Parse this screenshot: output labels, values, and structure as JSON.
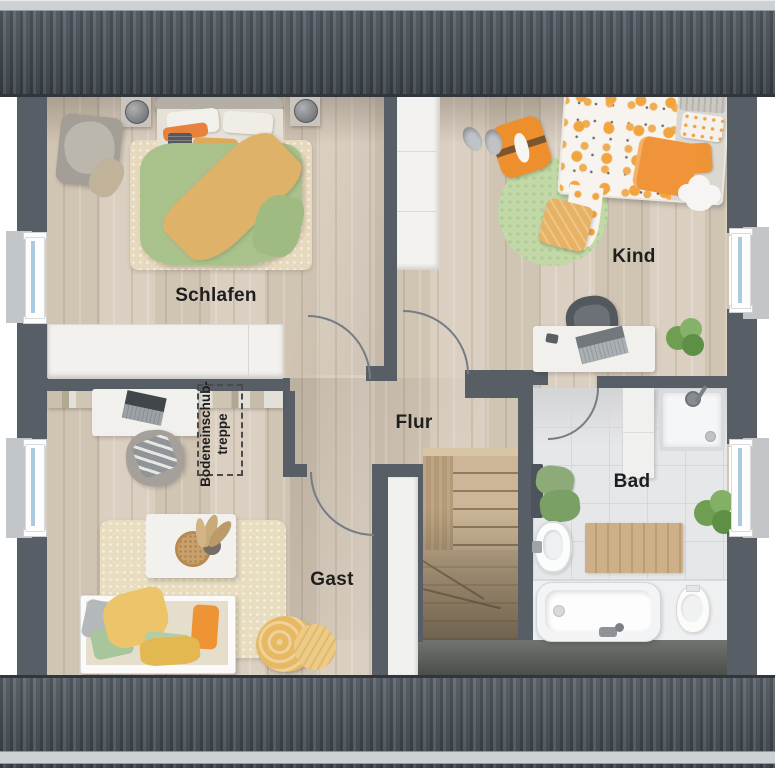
{
  "floorplan": {
    "type": "attic-floor-plan",
    "room_labels": [
      {
        "id": "schlafen",
        "label": "Schlafen"
      },
      {
        "id": "kind",
        "label": "Kind"
      },
      {
        "id": "flur",
        "label": "Flur"
      },
      {
        "id": "bad",
        "label": "Bad"
      },
      {
        "id": "gast",
        "label": "Gast"
      }
    ],
    "annotations": [
      {
        "id": "attic-hatch",
        "line1": "Bodeneinschub-",
        "line2": "treppe"
      }
    ],
    "colors": {
      "background": "#ffffff",
      "roof_dark": "#4a515a",
      "roof_stripe": "#394047",
      "roof_cap": "#ced1d4",
      "wall": "#575e66",
      "wood_floor": "#d7cbbb",
      "bathroom_tile": "#e6e7e9",
      "window_glass": "#a9cadf",
      "stair_wood": "#c6b192",
      "accent_orange": "#ee9434",
      "accent_green": "#a8c48e",
      "accent_yellow": "#e5b95f"
    },
    "furniture": {
      "schlafen": [
        "double-bed",
        "nightstand-lamps",
        "rug",
        "wardrobe",
        "bookshelf",
        "armchair-clothes"
      ],
      "kind": [
        "single-bed",
        "round-rug",
        "wardrobe",
        "desk",
        "desk-chair",
        "slippers",
        "floor-pillow",
        "cloud-rug",
        "plant"
      ],
      "gast": [
        "daybed",
        "coffee-table",
        "rug",
        "desk",
        "armchair",
        "blanket"
      ],
      "bad": [
        "shower",
        "bathtub",
        "toilet",
        "sink",
        "bath-mat",
        "towels",
        "plant",
        "cabinet"
      ],
      "flur": [
        "staircase",
        "attic-hatch"
      ]
    }
  }
}
